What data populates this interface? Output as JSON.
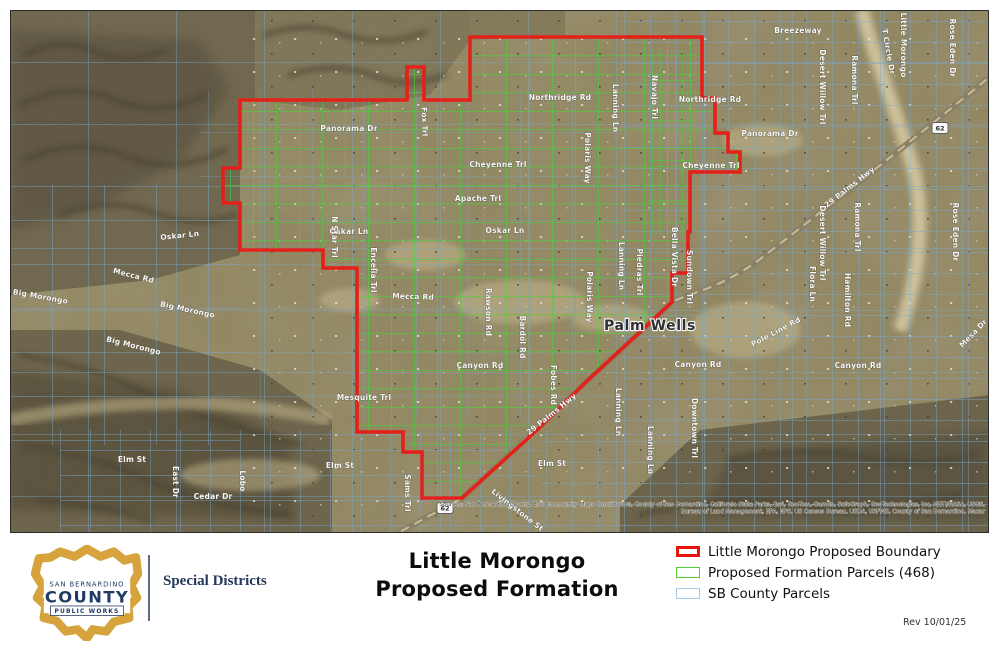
{
  "map": {
    "place_labels": [
      {
        "text": "Palm Wells",
        "x": 650,
        "y": 330
      }
    ],
    "route_shields": [
      {
        "label": "62",
        "x": 445,
        "y": 508
      },
      {
        "label": "62",
        "x": 940,
        "y": 128
      }
    ],
    "street_labels": [
      {
        "text": "Breezeway",
        "x": 798,
        "y": 33,
        "rot": 0
      },
      {
        "text": "Northridge Rd",
        "x": 560,
        "y": 100,
        "rot": 0
      },
      {
        "text": "Northridge Rd",
        "x": 710,
        "y": 102,
        "rot": 0
      },
      {
        "text": "Panorama Dr",
        "x": 349,
        "y": 131,
        "rot": 0
      },
      {
        "text": "Panorama Dr",
        "x": 770,
        "y": 136,
        "rot": 0
      },
      {
        "text": "Cheyenne Trl",
        "x": 498,
        "y": 167,
        "rot": 0
      },
      {
        "text": "Cheyenne Trl",
        "x": 711,
        "y": 168,
        "rot": 0
      },
      {
        "text": "Apache Trl",
        "x": 478,
        "y": 201,
        "rot": 0
      },
      {
        "text": "Oskar Ln",
        "x": 180,
        "y": 238,
        "rot": -6
      },
      {
        "text": "Oskar Ln",
        "x": 349,
        "y": 234,
        "rot": 0
      },
      {
        "text": "Oskar Ln",
        "x": 505,
        "y": 233,
        "rot": 0
      },
      {
        "text": "Mecca Rd",
        "x": 133,
        "y": 278,
        "rot": 14
      },
      {
        "text": "Mecca Rd",
        "x": 413,
        "y": 299,
        "rot": 2
      },
      {
        "text": "Canyon Rd",
        "x": 480,
        "y": 368,
        "rot": 0
      },
      {
        "text": "Canyon Rd",
        "x": 698,
        "y": 367,
        "rot": 0
      },
      {
        "text": "Canyon Rd",
        "x": 858,
        "y": 368,
        "rot": 0
      },
      {
        "text": "Mesquite Trl",
        "x": 364,
        "y": 400,
        "rot": 0
      },
      {
        "text": "Elm St",
        "x": 132,
        "y": 462,
        "rot": 0
      },
      {
        "text": "Elm St",
        "x": 340,
        "y": 468,
        "rot": 0
      },
      {
        "text": "Elm St",
        "x": 552,
        "y": 466,
        "rot": 0
      },
      {
        "text": "Cedar Dr",
        "x": 213,
        "y": 499,
        "rot": 0
      },
      {
        "text": "East Dr",
        "x": 173,
        "y": 482,
        "rot": 90
      },
      {
        "text": "Lobo",
        "x": 240,
        "y": 481,
        "rot": 90
      },
      {
        "text": "Fox Trl",
        "x": 422,
        "y": 122,
        "rot": 88
      },
      {
        "text": "N Star Trl",
        "x": 332,
        "y": 237,
        "rot": 90
      },
      {
        "text": "Encelia Trl",
        "x": 371,
        "y": 270,
        "rot": 90
      },
      {
        "text": "Rawson Rd",
        "x": 486,
        "y": 312,
        "rot": 90
      },
      {
        "text": "Bardol Rd",
        "x": 520,
        "y": 337,
        "rot": 90
      },
      {
        "text": "Fobes Rd",
        "x": 551,
        "y": 385,
        "rot": 90
      },
      {
        "text": "Polaris Way",
        "x": 585,
        "y": 158,
        "rot": 90
      },
      {
        "text": "Polaris Way",
        "x": 587,
        "y": 297,
        "rot": 90
      },
      {
        "text": "Lanning Ln",
        "x": 613,
        "y": 108,
        "rot": 90
      },
      {
        "text": "Lanning Ln",
        "x": 619,
        "y": 266,
        "rot": 90
      },
      {
        "text": "Lanning Ln",
        "x": 616,
        "y": 412,
        "rot": 90
      },
      {
        "text": "Lanning Ln",
        "x": 648,
        "y": 450,
        "rot": 90
      },
      {
        "text": "Navajo Trl",
        "x": 652,
        "y": 97,
        "rot": 90
      },
      {
        "text": "Downtown Trl",
        "x": 692,
        "y": 428,
        "rot": 90
      },
      {
        "text": "Bella Vista Dr",
        "x": 672,
        "y": 257,
        "rot": 90
      },
      {
        "text": "Sundown Trl",
        "x": 687,
        "y": 277,
        "rot": 90
      },
      {
        "text": "Piedras Trl",
        "x": 637,
        "y": 272,
        "rot": 90
      },
      {
        "text": "Desert Willow Trl",
        "x": 820,
        "y": 87,
        "rot": 90
      },
      {
        "text": "Desert Willow Trl",
        "x": 820,
        "y": 243,
        "rot": 90
      },
      {
        "text": "Ramona Trl",
        "x": 852,
        "y": 80,
        "rot": 90
      },
      {
        "text": "Ramona Trl",
        "x": 855,
        "y": 227,
        "rot": 90
      },
      {
        "text": "T Circle Dr",
        "x": 886,
        "y": 52,
        "rot": 80
      },
      {
        "text": "Little Morongo",
        "x": 901,
        "y": 45,
        "rot": 90
      },
      {
        "text": "Rose Eden Dr",
        "x": 950,
        "y": 48,
        "rot": 90
      },
      {
        "text": "Rose Eden Dr",
        "x": 953,
        "y": 232,
        "rot": 90
      },
      {
        "text": "Flora Ln",
        "x": 810,
        "y": 284,
        "rot": 90
      },
      {
        "text": "Hamilton Rd",
        "x": 845,
        "y": 300,
        "rot": 90
      },
      {
        "text": "Pole Line Rd",
        "x": 777,
        "y": 334,
        "rot": -28
      },
      {
        "text": "29 Palms Hwy",
        "x": 851,
        "y": 189,
        "rot": -38
      },
      {
        "text": "29 Palms Hwy",
        "x": 553,
        "y": 416,
        "rot": -39
      },
      {
        "text": "Livingstone St",
        "x": 516,
        "y": 512,
        "rot": 38
      },
      {
        "text": "Sams Trl",
        "x": 405,
        "y": 493,
        "rot": 90
      },
      {
        "text": "Big Morongo",
        "x": 187,
        "y": 312,
        "rot": 12
      },
      {
        "text": "Big Morongo",
        "x": 40,
        "y": 299,
        "rot": 10
      },
      {
        "text": "Big Morongo",
        "x": 133,
        "y": 348,
        "rot": 14
      },
      {
        "text": "Mesa Dr",
        "x": 975,
        "y": 335,
        "rot": -46
      }
    ],
    "boundary_path": "M240,100 L407,100 L407,67 L424,67 L424,100 L470,100 L470,37 L702,37 L702,98 L715,98 L715,133 L728,133 L728,152 L740,152 L740,172 L690,172 L690,232 L688,232 L688,273 L672,273 L672,302 L640,332 L590,378 L537,430 L462,498 L422,498 L422,452 L403,452 L403,432 L357,432 L357,268 L323,268 L323,250 L240,250 L240,203 L223,203 L223,168 L240,168 Z",
    "attribution_line1": "Sources: San Bernardino County, Esri Community Maps Contributors, County of San Bernardino, California State Parks, Esri, TomTom, Garmin, SafeGraph, GeoTechnologies, Inc, METI/NASA, USGS,",
    "attribution_line2": "Bureau of Land Management, EPA, NPS, US Census Bureau, USDA, USFWS, County of San Bernardino, Maxar",
    "colors": {
      "boundary": "#e8130c",
      "formation_parcel": "#3ed32b",
      "county_parcel": "#74a7d4"
    }
  },
  "footer": {
    "logo": {
      "line1": "SAN BERNARDINO",
      "line2": "COUNTY",
      "line3": "PUBLIC WORKS"
    },
    "department": "Special Districts",
    "title_line1": "Little Morongo",
    "title_line2": "Proposed Formation",
    "legend": [
      {
        "label": "Little Morongo Proposed Boundary",
        "swatch_color": "#e8130c",
        "swatch_border": 3
      },
      {
        "label": "Proposed Formation Parcels (468)",
        "swatch_color": "#55cc33",
        "swatch_border": 1.5
      },
      {
        "label": "SB County Parcels",
        "swatch_color": "#aac9e2",
        "swatch_border": 1
      }
    ],
    "revision": "Rev 10/01/25"
  }
}
